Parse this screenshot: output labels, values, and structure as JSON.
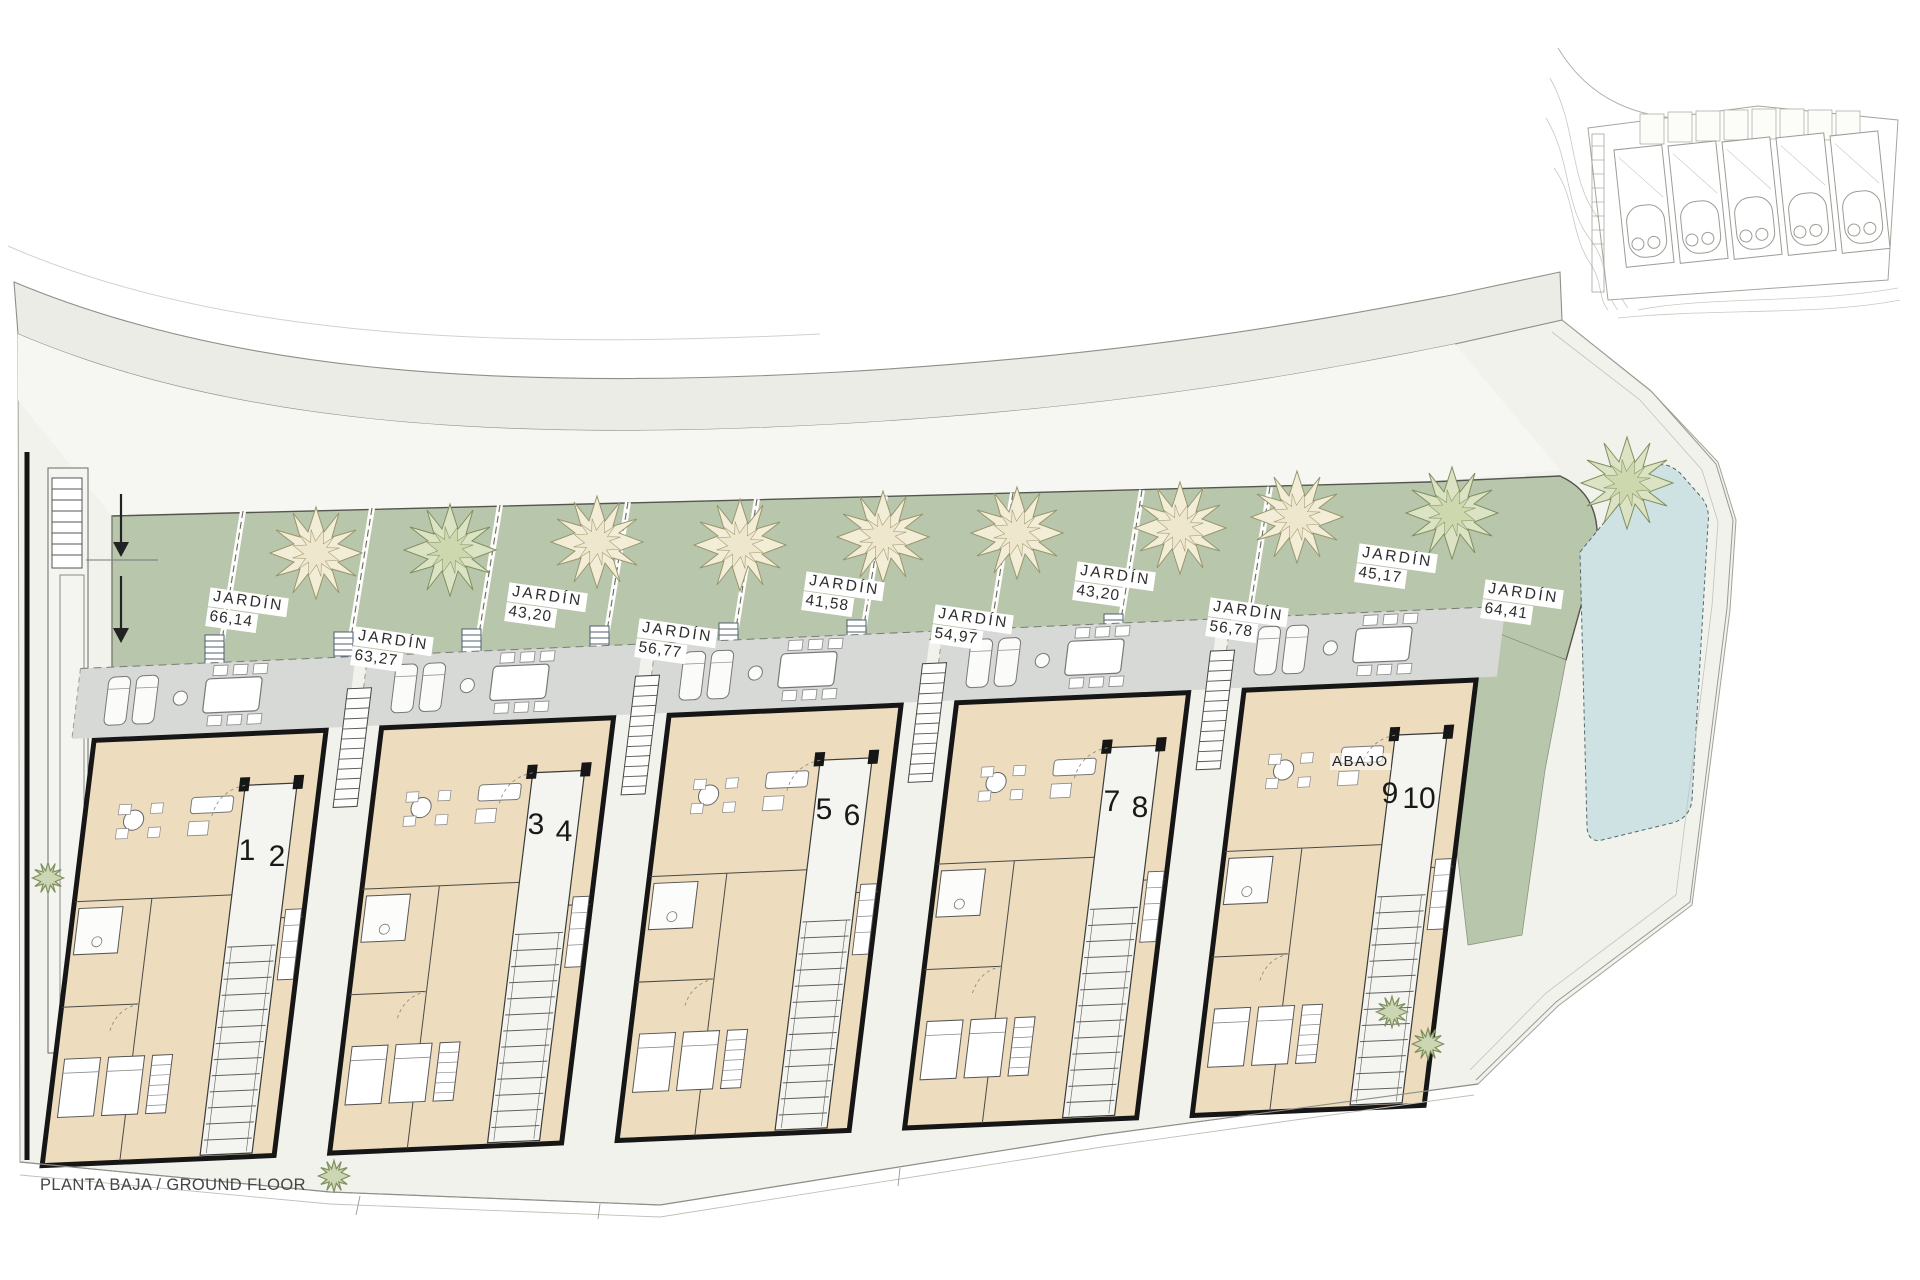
{
  "page": {
    "floor_label": "PLANTA BAJA / GROUND FLOOR"
  },
  "plan": {
    "gardens": [
      {
        "label": "JARDÍN",
        "area": "66,14"
      },
      {
        "label": "JARDÍN",
        "area": "63,27"
      },
      {
        "label": "JARDÍN",
        "area": "43,20"
      },
      {
        "label": "JARDÍN",
        "area": "56,77"
      },
      {
        "label": "JARDÍN",
        "area": "41,58"
      },
      {
        "label": "JARDÍN",
        "area": "54,97"
      },
      {
        "label": "JARDÍN",
        "area": "43,20"
      },
      {
        "label": "JARDÍN",
        "area": "56,78"
      },
      {
        "label": "JARDÍN",
        "area": "45,17"
      },
      {
        "label": "JARDÍN",
        "area": "64,41"
      }
    ],
    "units": [
      "1",
      "2",
      "3",
      "4",
      "5",
      "6",
      "7",
      "8",
      "9",
      "10"
    ],
    "stair_note": "ABAJO"
  },
  "colors": {
    "garden_green": "#b8c6ac",
    "terrace_grey": "#d6d9d5",
    "house_beige": "#eddcbd",
    "pool_blue": "#cfe2e3",
    "site_grey": "#f1f2ec",
    "road_grey": "#ebece6",
    "wall_black": "#161616"
  }
}
